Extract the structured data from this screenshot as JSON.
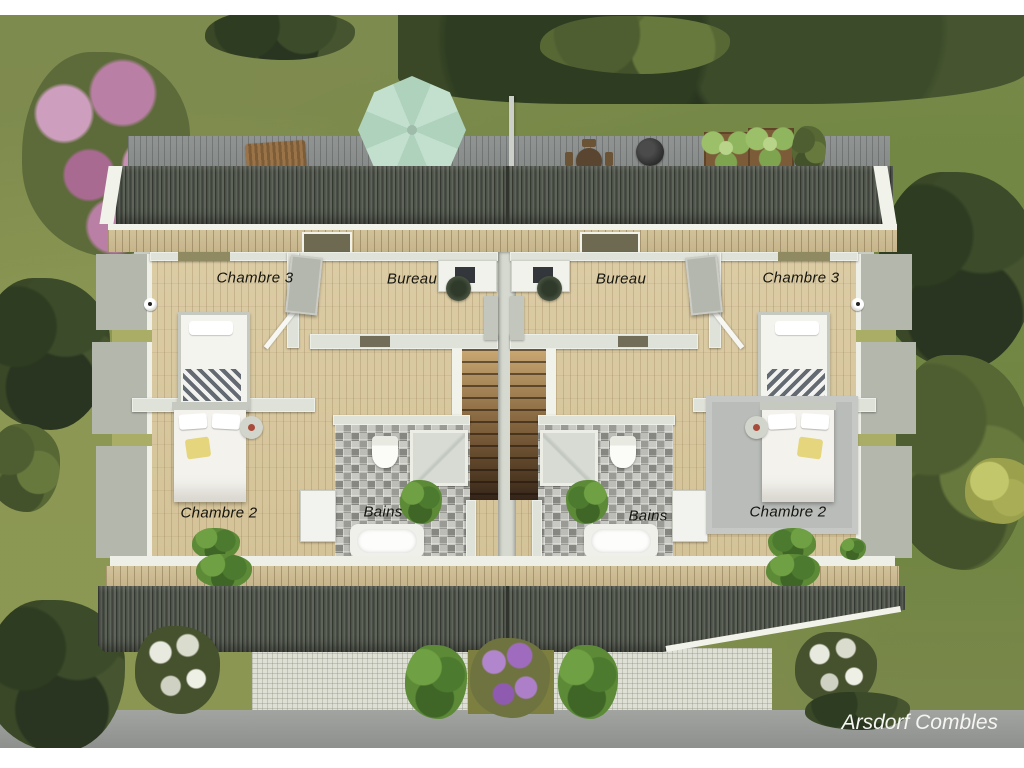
{
  "watermark": "Arsdorf Combles",
  "rooms": {
    "left": {
      "chambre3": "Chambre 3",
      "bureau": "Bureau",
      "chambre2": "Chambre 2",
      "bains": "Bains"
    },
    "right": {
      "bureau": "Bureau",
      "chambre3": "Chambre 3",
      "bains": "Bains",
      "chambre2": "Chambre 2"
    }
  },
  "palette": {
    "grass": "#7e8b4e",
    "roof": "#4b5046",
    "wood_floor": "#d8c8a0",
    "wall": "#dfe2d8",
    "parasol_mint": "#b9dcc7",
    "tile_gray": "#a3a39e",
    "road_gray": "#9b9d9a",
    "flower_pink": "#b97fa4",
    "flower_purple": "#9f6bbf",
    "stair_wood": "#8a6a42"
  }
}
